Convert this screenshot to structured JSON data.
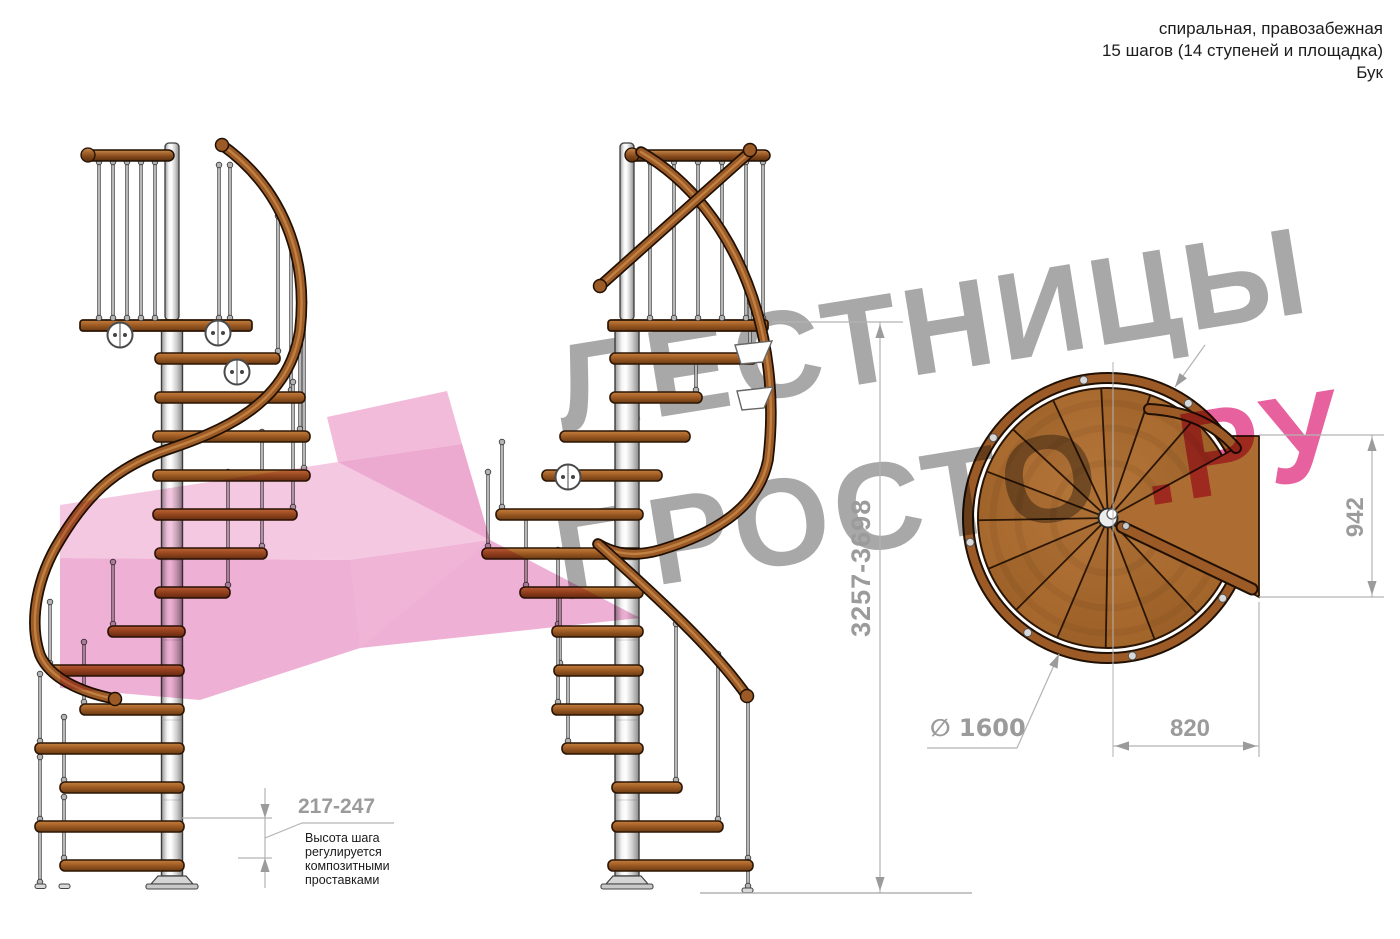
{
  "header": {
    "line1": "спиральная, правозабежная",
    "line2": "15 шагов (14 ступеней и площадка)",
    "line3": "Бук"
  },
  "dimensions": {
    "total_height": "3257-3698",
    "landing_width": "942",
    "landing_depth": "820",
    "diameter": "∅ 1600",
    "step_height": "217-247"
  },
  "note": {
    "line1": "Высота шага",
    "line2": "регулируется",
    "line3": "композитными",
    "line4": "проставками"
  },
  "watermark": {
    "word1": "ЛЕСТНИЦЫ",
    "word2": "ПРОСТО",
    "word3": ".РУ"
  },
  "colors": {
    "wood": "#a4622a",
    "wood_dark": "#2b1605",
    "rail": "#9c5b26",
    "rail_light": "#c98a4a",
    "steel_light": "#f5f5f5",
    "steel_dark": "#8f8f8f",
    "dim_line": "#b3b3b3",
    "dim_text": "#9b9b9b",
    "text": "#1c1c1c",
    "watermark_gray": "#a8a8a8",
    "watermark_pink": "#e8619f",
    "arrow_pink": "#f3bfdd"
  }
}
